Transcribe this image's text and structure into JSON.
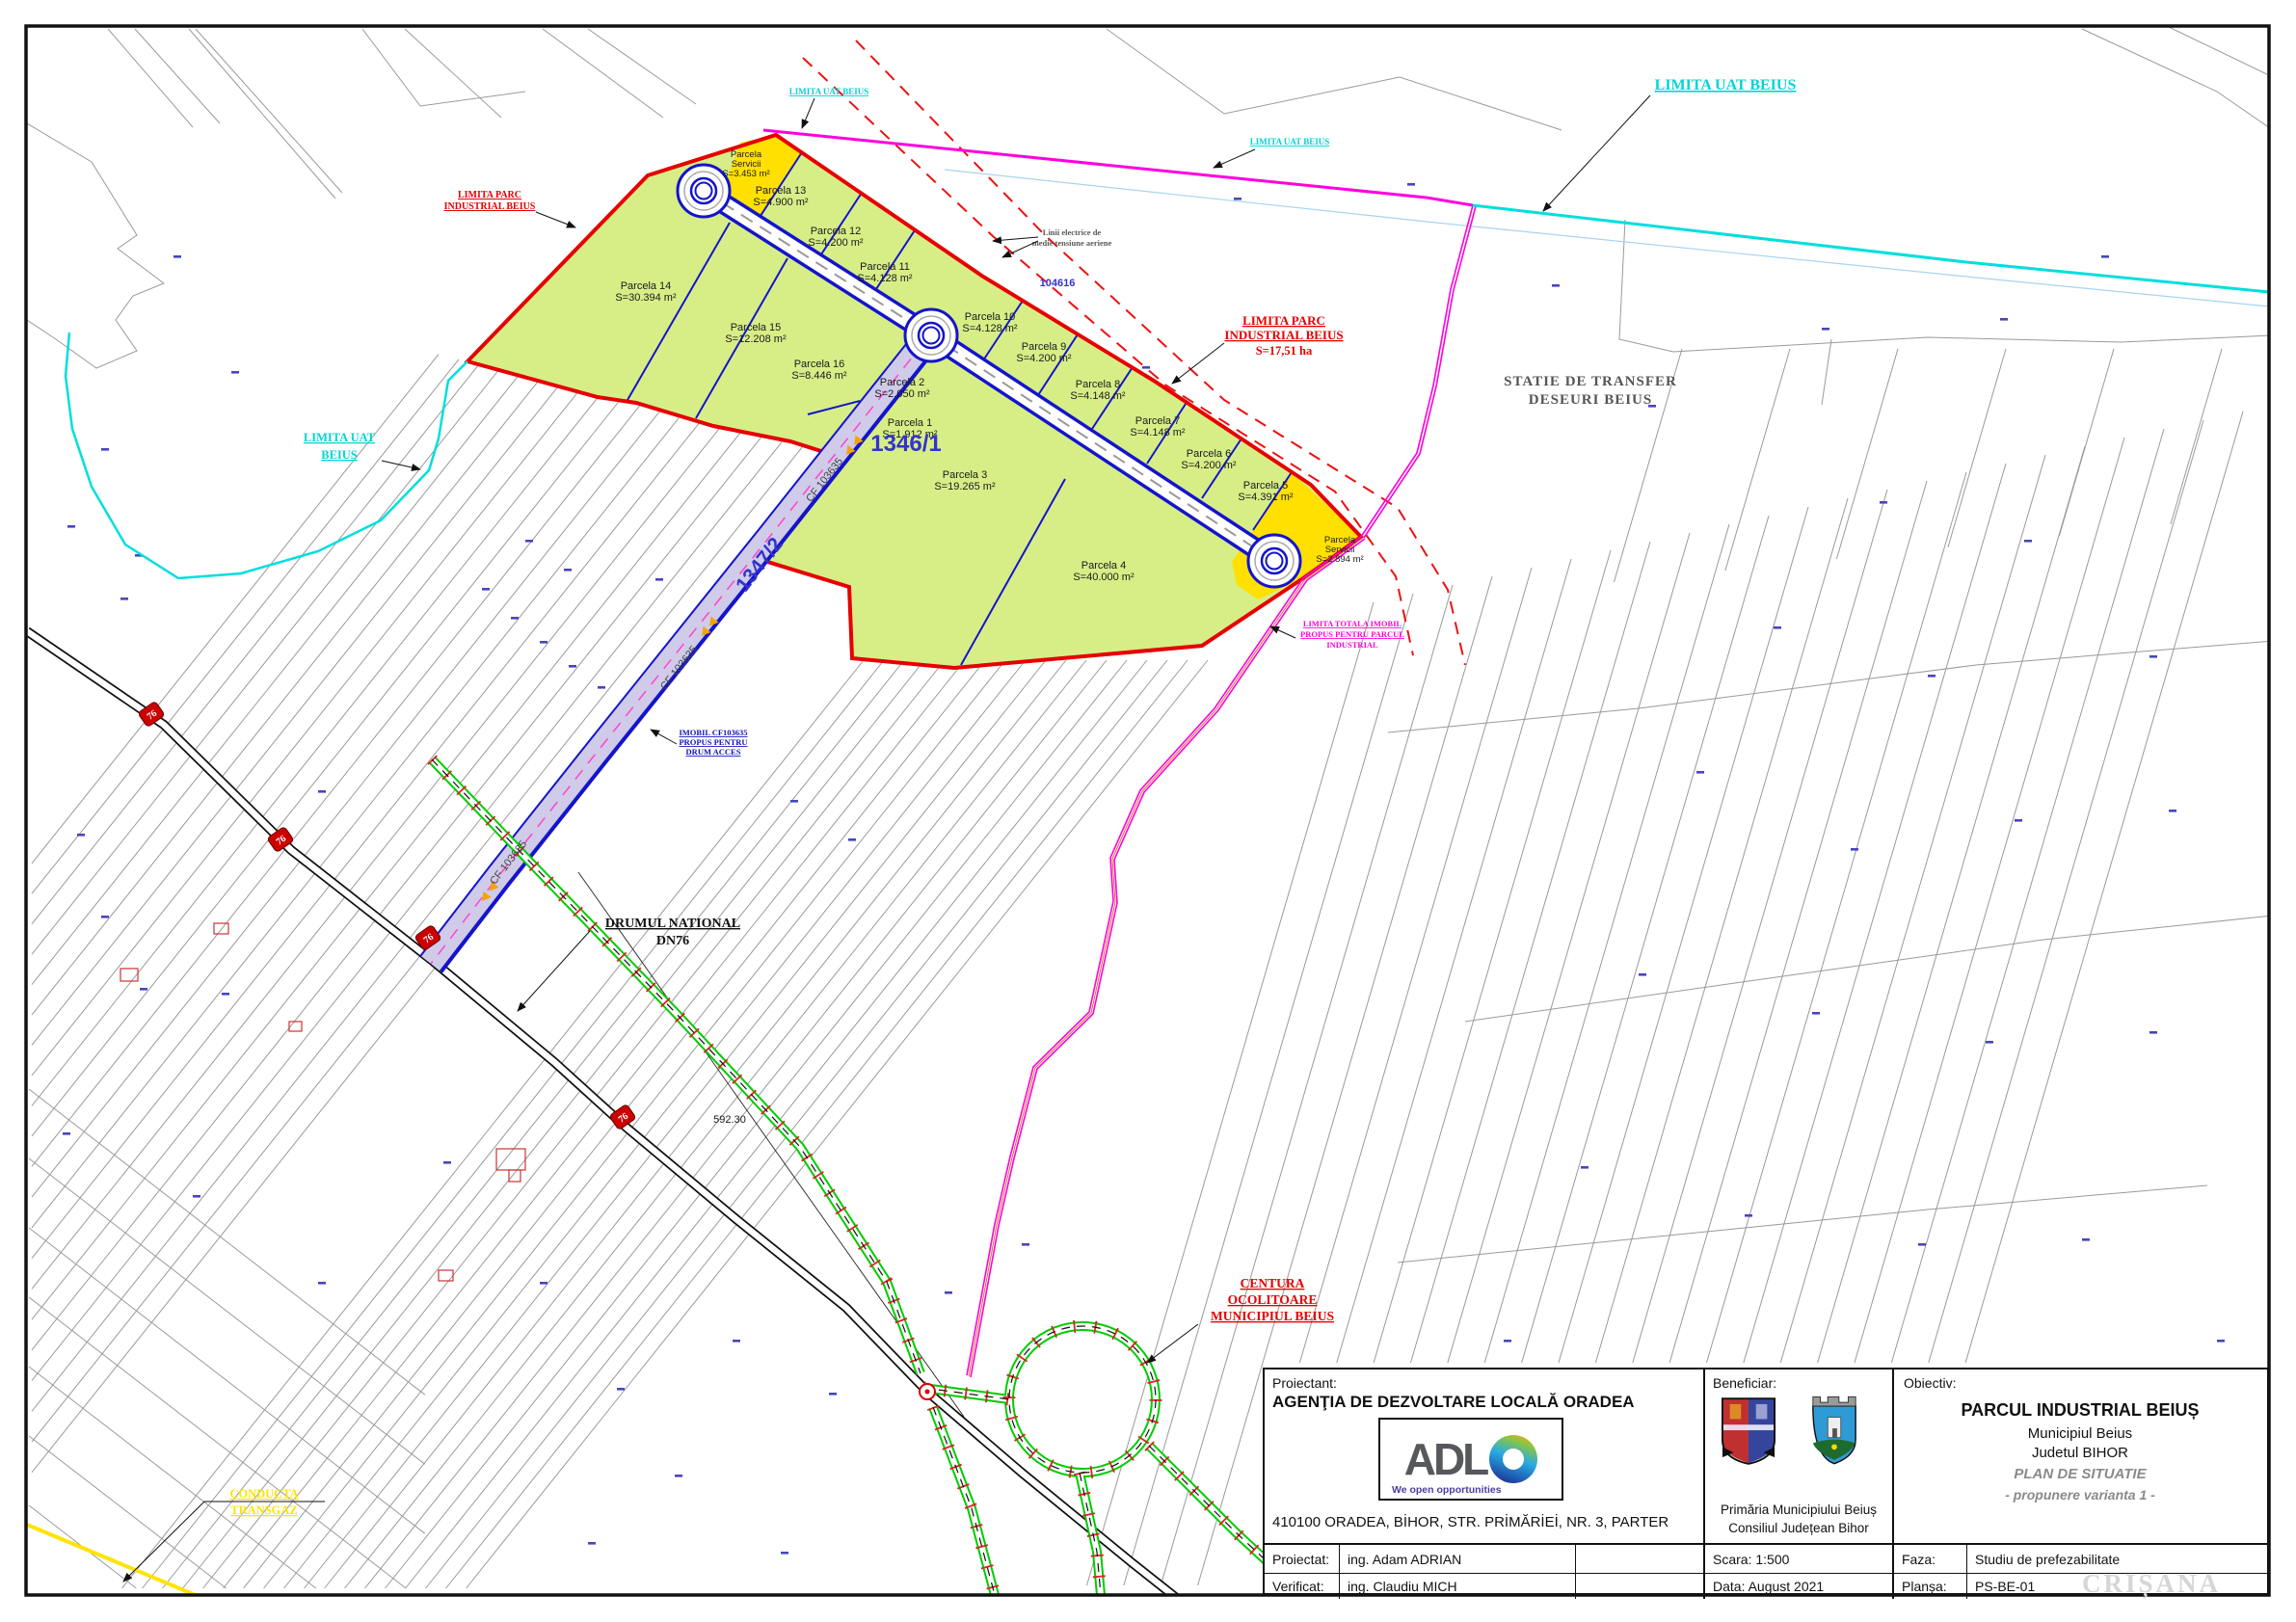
{
  "map": {
    "parcels": [
      {
        "l1": "Parcela",
        "l2": "Servicii",
        "l3": "S=3.453 m²"
      },
      {
        "l1": "Parcela 13",
        "l2": "S=4.900 m²"
      },
      {
        "l1": "Parcela 12",
        "l2": "S=4.200 m²"
      },
      {
        "l1": "Parcela 11",
        "l2": "S=4.128 m²"
      },
      {
        "l1": "Parcela 10",
        "l2": "S=4.128 m²"
      },
      {
        "l1": "Parcela 9",
        "l2": "S=4.200 m²"
      },
      {
        "l1": "Parcela 8",
        "l2": "S=4.148 m²"
      },
      {
        "l1": "Parcela 7",
        "l2": "S=4.148 m²"
      },
      {
        "l1": "Parcela 6",
        "l2": "S=4.200 m²"
      },
      {
        "l1": "Parcela 5",
        "l2": "S=4.391 m²"
      },
      {
        "l1": "Parcela",
        "l2": "Servicii",
        "l3": "S=2.894 m²"
      },
      {
        "l1": "Parcela 14",
        "l2": "S=30.394 m²"
      },
      {
        "l1": "Parcela 15",
        "l2": "S=12.208 m²"
      },
      {
        "l1": "Parcela 16",
        "l2": "S=8.446 m²"
      },
      {
        "l1": "Parcela 2",
        "l2": "S=2.050 m²"
      },
      {
        "l1": "Parcela 1",
        "l2": "S=1.912 m²"
      },
      {
        "l1": "Parcela 3",
        "l2": "S=19.265 m²"
      },
      {
        "l1": "Parcela 4",
        "l2": "S=40.000 m²"
      }
    ],
    "ids": {
      "main": "1346/1",
      "road": "1347/2",
      "cf": "CF 103635",
      "cad": "104616",
      "dim": "592.30",
      "shield": "76"
    },
    "ann": {
      "parc_left": [
        "LIMITA PARC",
        "INDUSTRIAL BEIUS"
      ],
      "parc_right": [
        "LIMITA PARC",
        "INDUSTRIAL BEIUS",
        "S=17,51 ha"
      ],
      "uat": "LIMITA UAT BEIUS",
      "uat_left": [
        "LIMITA UAT",
        "BEIUS"
      ],
      "totala": [
        "LIMITA TOTALA IMOBIL",
        "PROPUS PENTRU PARCUL",
        "INDUSTRIAL"
      ],
      "centura": [
        "CENTURA",
        "OCOLITOARE",
        "MUNICIPIUL BEIUS"
      ],
      "conducta": [
        "CONDUCTA",
        "TRANSGAZ"
      ],
      "imobil": [
        "IMOBIL CF103635",
        "PROPUS PENTRU",
        "DRUM ACCES"
      ],
      "electrice": [
        "Linii electrice de",
        "medie tensiune aeriene"
      ],
      "statie": [
        "STATIE DE TRANSFER",
        "DESEURI BEIUS"
      ],
      "dn": [
        "DRUMUL NATIONAL",
        "DN76"
      ]
    },
    "colors": {
      "park_fill": "#d7ee87",
      "services_fill": "#ffe000",
      "park_boundary": "#e60000",
      "road_blue": "#1414cc",
      "uat_cyan": "#00dede",
      "property_magenta": "#ff00dd",
      "bypass_green": "#00cc00",
      "pipeline_yellow": "#ffe400",
      "access_road_fill": "#cfcbe9"
    }
  },
  "title_block": {
    "proiectant_label": "Proiectant:",
    "proiectant": "AGENŢIA DE DEZVOLTARE LOCALĂ ORADEA",
    "logo_text": "ADL",
    "logo_tagline": "We open opportunities",
    "address": "410100 ORADEA, BİHOR, STR. PRİMĂRİEİ, NR. 3, PARTER",
    "proiectat_label": "Proiectat:",
    "proiectat": "ing. Adam ADRIAN",
    "verificat_label": "Verificat:",
    "verificat": "ing. Claudiu MICH",
    "beneficiar_label": "Beneficiar:",
    "beneficiar1": "Primăria Municipiului Beiuș",
    "beneficiar2": "Consiliul Județean Bihor",
    "scara": "Scara: 1:500",
    "data": "Data: August 2021",
    "obiectiv_label": "Obiectiv:",
    "obiectiv_title": "PARCUL INDUSTRIAL BEIUȘ",
    "obiectiv_sub1": "Municipiul Beius",
    "obiectiv_sub2": "Judetul BIHOR",
    "obiectiv_plan": "PLAN DE SITUATIE",
    "obiectiv_variant": "- propunere varianta 1 -",
    "faza_label": "Faza:",
    "faza": "Studiu de prefezabilitate",
    "plansa_label": "Planșa:",
    "plansa": "PS-BE-01",
    "watermark": "CRIȘANA"
  }
}
